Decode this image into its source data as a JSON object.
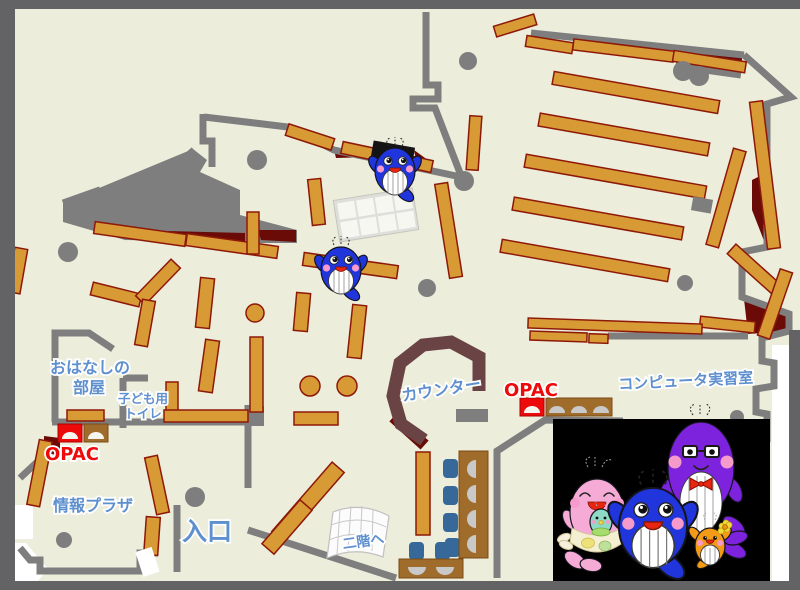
{
  "labels": {
    "storytime_room_line1": "おはなしの",
    "storytime_room_line2": "部屋",
    "kids_toilet_line1": "子ども用",
    "kids_toilet_line2": "トイレ",
    "opac_left": "OPAC",
    "info_plaza": "情報プラザ",
    "entrance": "入口",
    "counter": "カウンター",
    "opac_right": "OPAC",
    "computer_room": "コンピュータ実習室",
    "stairs_upper": "二階へ"
  },
  "colors": {
    "floor": "#EDEDDC",
    "frame": "#636366",
    "wall": "#7E7E7E",
    "shelf": "#D79A35",
    "shelf_border": "#8E1808",
    "maroon": "#6A0B07",
    "counter_brown": "#6A4444",
    "desk_brown": "#A06C2B",
    "accent_red": "#EE0A0A",
    "label_blue": "#5E8FCE",
    "chair_blue": "#36699A",
    "mascot_blue": "#2036DC",
    "mascot_purple": "#7D22DD",
    "mascot_pink": "#F6ABD7",
    "mascot_orange": "#F39A16",
    "mascot_teal": "#8EDAC6"
  },
  "mascots": {
    "map_whale_count": 2,
    "family": [
      "pink-mother-whale",
      "teal-baby-whale",
      "blue-child-whale",
      "purple-father-whale",
      "orange-child-whale"
    ]
  }
}
